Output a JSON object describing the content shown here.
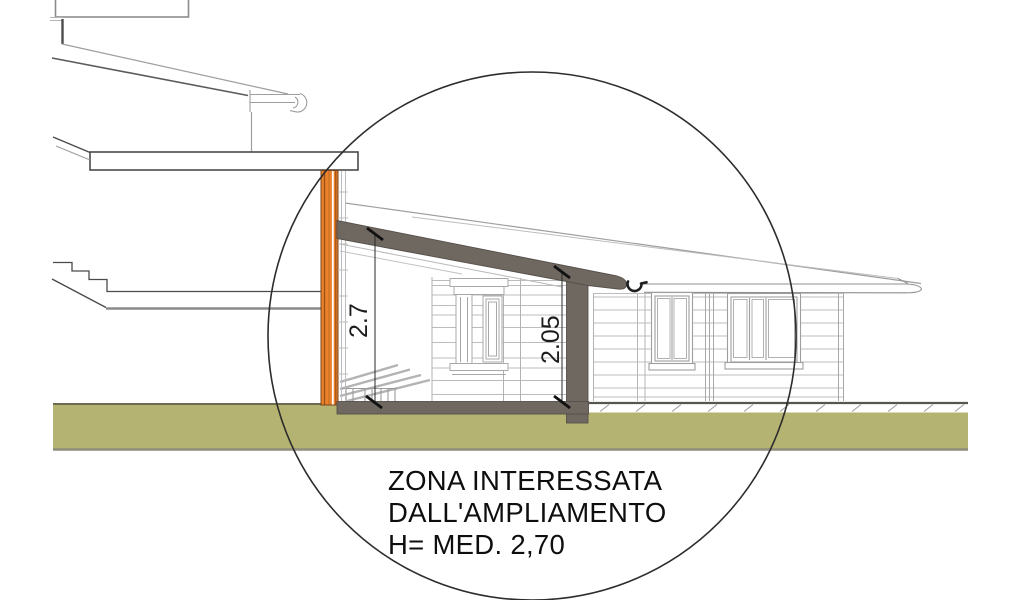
{
  "drawing": {
    "type": "architectural-section-elevation",
    "callout": {
      "line1": "ZONA INTERESSATA",
      "line2": "DALL'AMPLIAMENTO",
      "line3": "H= MED. 2,70"
    },
    "dimensions": {
      "interior_height_left": "2.7",
      "interior_height_right": "2.05"
    },
    "colors": {
      "highlight_wall_orange": "#E8822C",
      "wall_stripe_dark": "#9C4F16",
      "section_gray": "#6F6861",
      "section_gray_edge": "#57504A",
      "ground_green": "#B4B372",
      "ground_edge_dark": "#6B6B4F",
      "ground_edge_bottom": "#8E8E7C",
      "line_dark": "#3B3B3B",
      "line_light": "#ABABAB",
      "gutter_dark": "#1F1F1F",
      "circle_stroke": "#2D2D2D"
    }
  }
}
